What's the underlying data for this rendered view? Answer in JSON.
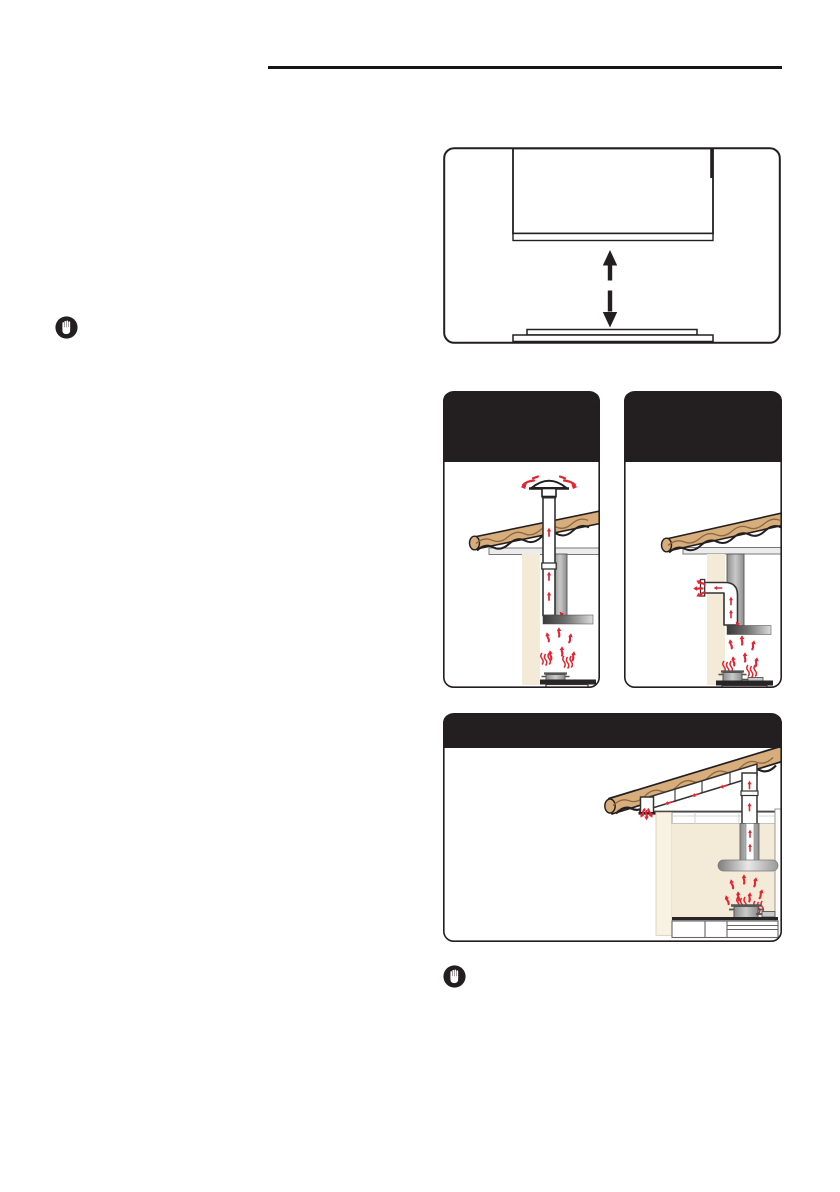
{
  "page": {
    "width": 840,
    "height": 1192,
    "background": "#ffffff",
    "kind": "installation-manual-page"
  },
  "rule": {
    "color": "#161616"
  },
  "colors": {
    "ink": "#231f20",
    "red": "#e42430",
    "tile-tan": "#d7ad7c",
    "tile-line": "#8a6844",
    "beige": "#f3ead7",
    "beige-light": "#f8f2e3",
    "rule": "#161616",
    "paper": "#ffffff"
  },
  "figures": {
    "clearance": {
      "name": "hood-to-hob-clearance-diagram",
      "header_text": "",
      "elements": [
        "cooker-hood",
        "clearance-double-arrow",
        "hob"
      ]
    },
    "roof_outlet": {
      "name": "roof-outlet-diagram",
      "header_text": "",
      "elements": [
        "roof-cowl",
        "vertical-duct",
        "tiled-roof",
        "cooker-hood",
        "hob",
        "airflow-arrows"
      ]
    },
    "wall_outlet": {
      "name": "wall-outlet-diagram",
      "header_text": "",
      "elements": [
        "wall-duct-elbow",
        "vertical-duct",
        "tiled-roof",
        "cooker-hood",
        "hob",
        "airflow-arrows"
      ]
    },
    "eave_outlet": {
      "name": "eave-outlet-diagram",
      "header_text": "",
      "elements": [
        "under-roof-duct",
        "eave-outlet",
        "tiled-roof",
        "chimney-hood",
        "hob",
        "kitchen-cabinets",
        "airflow-arrows"
      ]
    }
  },
  "notes": [
    {
      "icon": "hand-stop-icon"
    },
    {
      "icon": "hand-stop-icon"
    }
  ]
}
